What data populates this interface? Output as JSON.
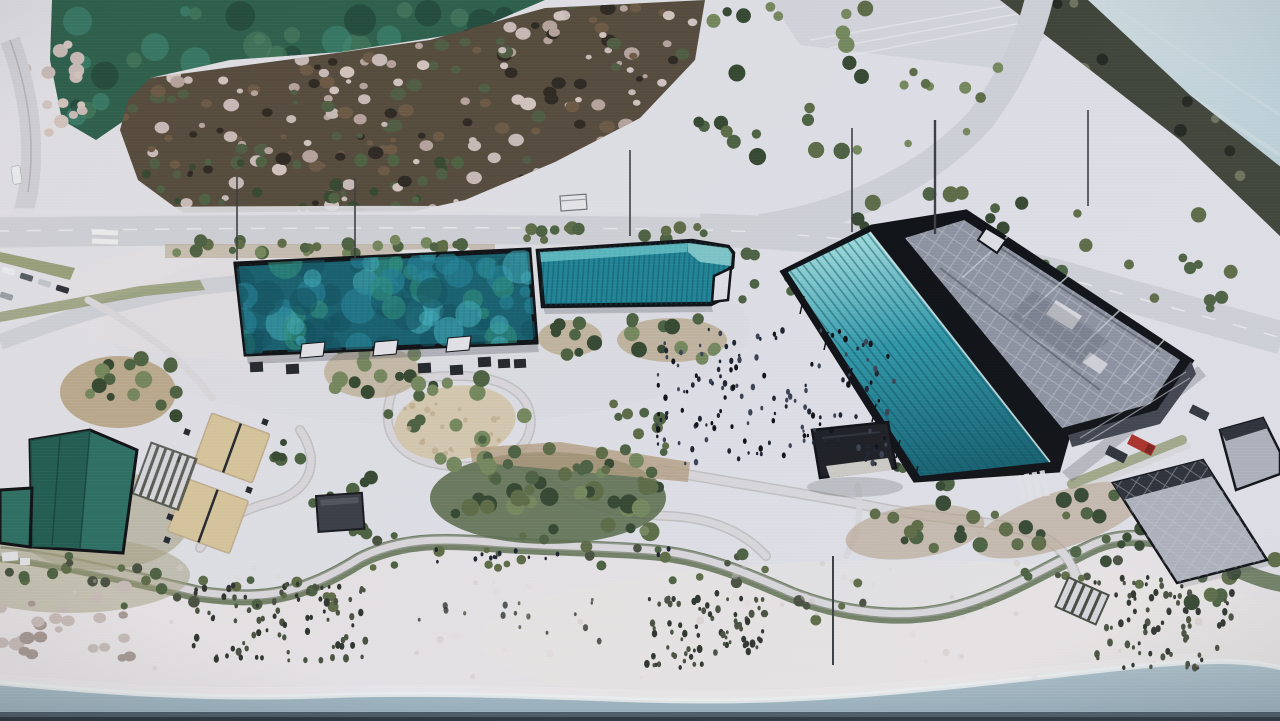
{
  "scene": {
    "kind": "photo-of-architectural-site-plan-rendering",
    "palette": {
      "base": "#e3e3e9",
      "sea": "#b7ced6",
      "sea_light": "#d6e1e4",
      "pond": "#2b5f4c",
      "pond_light": "#498063",
      "pond_dark": "#1b3b32",
      "pond_teal": "#3e8a78",
      "marsh": "#544a3c",
      "blossom": "#d5c6c1",
      "blossom2": "#b7a49d",
      "veg_dark": "#2d2721",
      "veg_brown": "#6b5844",
      "veg_green": "#4e5c42",
      "band": "#3f4337",
      "band_light": "#6e725c",
      "band_dark": "#23261f",
      "road": "#d2d3d9",
      "road_edge": "#a7a8ae",
      "dash": "#f0f1f3",
      "verge": "#86905f",
      "verge_soil": "#b3a489",
      "island": "#bcab8d",
      "lawn": "#a49f7d",
      "court": "#d9c79c",
      "court_line": "#24272e",
      "oval": "#d8cab0",
      "oval_dot": "#c2ae8e",
      "bed": "#b59d80",
      "mound": "#5d6e4e",
      "tree_dark": "#35472f",
      "tree_green": "#4c6140",
      "tree_light": "#75875c",
      "tree_olive": "#5d6b45",
      "roof1_base": "#17606f",
      "roof1_a": "#3fa9b5",
      "roof1_b": "#23849a",
      "roof1_c": "#11505f",
      "roof1_d": "#2f8f7c",
      "b2_top": "#6ecbcf",
      "b2_mid": "#1f8496",
      "b2_tip": "#8fd4d4",
      "b2_stripe": "#0c4f5f",
      "canopy_light": "#9fdede",
      "canopy_mid": "#2e97a8",
      "canopy_deep": "#14606f",
      "canopy_stripe": "#0d4f5e",
      "roof3": "#8e93a0",
      "roof3_light": "#c9ccd5",
      "roof3_dark": "#50545e",
      "facade": "#3f434d",
      "black": "#0d0f12",
      "left_roof": "#2c6e62",
      "left_roof_dark": "#1f584e",
      "gazebo": "#1b1d22",
      "floor": "#cfccc6",
      "shelter": "#3a3d44",
      "rgray": "#aeb2bc",
      "rgray_dark": "#2b2e36",
      "sand": "#eae6e8",
      "sand_warm": "#e2d8d6",
      "water": "#afc3cc",
      "water_deep": "#97aeba",
      "foam": "#f1f3f2",
      "shore_strip": "#46525c",
      "shore_deep": "#2b353d",
      "grass_dark": "#2e332c",
      "grass_mid": "#49503f",
      "crowd_a": "#1d222e",
      "crowd_b": "#394050",
      "rock_a": "#cabdb9",
      "rock_b": "#a89a94",
      "path_c": "#dcdadd",
      "path_edge": "#a5a49f",
      "red_truck": "#ab2f26",
      "van": "#2c3038",
      "white_v": "#eceff1",
      "car_a": "#c4c8cd",
      "car_b": "#565c64",
      "car_c": "#9aa0a6",
      "pole": "#3a3d40",
      "hut": "#e9e9ed",
      "steps": "#d9d9de",
      "steps_bg": "#44483f",
      "wash_cool": "#d7d7e0",
      "wash_warm": "#efe7e3",
      "shadow": "#5b5e66",
      "stall": "#23262b",
      "notch": "#e6e6ea"
    },
    "scatter": [
      {
        "id": "pondTex",
        "x": 70,
        "y": 2,
        "w": 440,
        "h": 120,
        "n": 48,
        "rmin": 5,
        "rmax": 16,
        "colors": [
          "pond_light",
          "pond_dark",
          "pond_teal"
        ],
        "op": 0.55,
        "sq": 1,
        "seed": 11
      },
      {
        "id": "marshTex",
        "x": 85,
        "y": 0,
        "w": 610,
        "h": 225,
        "n": 300,
        "rmin": 2.5,
        "rmax": 8,
        "colors": [
          "blossom",
          "blossom2",
          "veg_dark",
          "veg_brown",
          "veg_green",
          "rock_a"
        ],
        "op": 1,
        "sq": 0.8,
        "seed": 12
      },
      {
        "id": "marshEdge",
        "x": 100,
        "y": 158,
        "w": 370,
        "h": 62,
        "n": 42,
        "rmin": 3,
        "rmax": 7,
        "colors": [
          "veg_green",
          "tree_dark",
          "tree_green"
        ],
        "op": 1,
        "sq": 1,
        "seed": 58
      },
      {
        "id": "bandTex",
        "x": 990,
        "y": 0,
        "w": 290,
        "h": 240,
        "n": 60,
        "rmin": 3,
        "rmax": 8,
        "colors": [
          "band_light",
          "band_dark"
        ],
        "op": 1,
        "sq": 1,
        "seed": 13
      },
      {
        "id": "roof1Tex",
        "x": 238,
        "y": 252,
        "w": 296,
        "h": 98,
        "n": 85,
        "rmin": 5,
        "rmax": 18,
        "colors": [
          "roof1_a",
          "roof1_b",
          "roof1_c",
          "roof1_d"
        ],
        "op": 0.6,
        "sq": 1,
        "seed": 14
      },
      {
        "id": "rowSouth",
        "x": 168,
        "y": 240,
        "w": 325,
        "h": 14,
        "n": 26,
        "rmin": 3.5,
        "rmax": 7,
        "colors": [
          "tree_olive",
          "tree_green",
          "tree_light"
        ],
        "op": 1,
        "sq": 1,
        "seed": 15
      },
      {
        "id": "rowEast",
        "x": 498,
        "y": 226,
        "w": 208,
        "h": 14,
        "n": 14,
        "rmin": 3.5,
        "rmax": 7,
        "colors": [
          "tree_olive",
          "tree_green"
        ],
        "op": 1,
        "sq": 1,
        "seed": 16
      },
      {
        "id": "neTreesA",
        "x": 848,
        "y": 186,
        "w": 200,
        "h": 44,
        "n": 10,
        "rmin": 4,
        "rmax": 8,
        "colors": [
          "tree_green",
          "tree_olive",
          "tree_dark"
        ],
        "op": 1,
        "sq": 1,
        "seed": 17
      },
      {
        "id": "neTreesB",
        "x": 1035,
        "y": 212,
        "w": 170,
        "h": 60,
        "n": 9,
        "rmin": 4,
        "rmax": 8,
        "colors": [
          "tree_green",
          "tree_olive"
        ],
        "op": 1,
        "sq": 1,
        "seed": 18
      },
      {
        "id": "neTreesC",
        "x": 1130,
        "y": 270,
        "w": 120,
        "h": 50,
        "n": 5,
        "rmin": 4,
        "rmax": 7,
        "colors": [
          "tree_olive",
          "tree_green"
        ],
        "op": 1,
        "sq": 1,
        "seed": 19
      },
      {
        "id": "topMidA",
        "x": 695,
        "y": 5,
        "w": 175,
        "h": 160,
        "n": 24,
        "rmin": 4,
        "rmax": 9,
        "colors": [
          "tree_green",
          "tree_dark",
          "tree_light",
          "tree_olive"
        ],
        "op": 1,
        "sq": 1,
        "seed": 20
      },
      {
        "id": "topMidB",
        "x": 862,
        "y": 30,
        "w": 150,
        "h": 115,
        "n": 9,
        "rmin": 3.5,
        "rmax": 7,
        "colors": [
          "tree_olive",
          "tree_light"
        ],
        "op": 1,
        "sq": 1,
        "seed": 21
      },
      {
        "id": "c1Trees",
        "x": 78,
        "y": 358,
        "w": 100,
        "h": 62,
        "n": 15,
        "rmin": 4,
        "rmax": 9,
        "colors": [
          "tree_dark",
          "tree_green",
          "tree_light"
        ],
        "op": 1,
        "sq": 1,
        "seed": 22
      },
      {
        "id": "c2Trees",
        "x": 330,
        "y": 345,
        "w": 85,
        "h": 50,
        "n": 12,
        "rmin": 4,
        "rmax": 8,
        "colors": [
          "tree_dark",
          "tree_green",
          "tree_light"
        ],
        "op": 1,
        "sq": 1,
        "seed": 23
      },
      {
        "id": "ovalRing",
        "x": 385,
        "y": 372,
        "w": 145,
        "h": 92,
        "n": 17,
        "rmin": 4,
        "rmax": 9,
        "colors": [
          "tree_dark",
          "tree_green",
          "tree_light"
        ],
        "op": 1,
        "sq": 1,
        "seed": 24
      },
      {
        "id": "moundTrees",
        "x": 438,
        "y": 460,
        "w": 225,
        "h": 72,
        "n": 36,
        "rmin": 4.5,
        "rmax": 10,
        "colors": [
          "tree_dark",
          "tree_green",
          "tree_light",
          "tree_olive"
        ],
        "op": 1,
        "sq": 1,
        "seed": 25
      },
      {
        "id": "bedTrees",
        "x": 470,
        "y": 441,
        "w": 220,
        "h": 40,
        "n": 15,
        "rmin": 3.5,
        "rmax": 7,
        "colors": [
          "tree_green",
          "tree_olive"
        ],
        "op": 1,
        "sq": 1,
        "seed": 26
      },
      {
        "id": "mAtrees",
        "x": 542,
        "y": 313,
        "w": 60,
        "h": 42,
        "n": 8,
        "rmin": 4,
        "rmax": 8,
        "colors": [
          "tree_dark",
          "tree_green"
        ],
        "op": 1,
        "sq": 1,
        "seed": 27
      },
      {
        "id": "mBtrees",
        "x": 625,
        "y": 316,
        "w": 100,
        "h": 44,
        "n": 12,
        "rmin": 4,
        "rmax": 8,
        "colors": [
          "tree_dark",
          "tree_green",
          "tree_light"
        ],
        "op": 1,
        "sq": 1,
        "seed": 28
      },
      {
        "id": "c7Trees",
        "x": 605,
        "y": 393,
        "w": 58,
        "h": 46,
        "n": 7,
        "rmin": 4,
        "rmax": 7,
        "colors": [
          "tree_green",
          "tree_olive"
        ],
        "op": 1,
        "sq": 1,
        "seed": 29
      },
      {
        "id": "c9Trees",
        "x": 925,
        "y": 262,
        "w": 110,
        "h": 62,
        "n": 13,
        "rmin": 4,
        "rmax": 9,
        "colors": [
          "tree_dark",
          "tree_green",
          "tree_light"
        ],
        "op": 1,
        "sq": 1,
        "seed": 30
      },
      {
        "id": "gapTrees",
        "x": 735,
        "y": 253,
        "w": 60,
        "h": 48,
        "n": 6,
        "rmin": 4,
        "rmax": 7,
        "colors": [
          "tree_green",
          "tree_olive"
        ],
        "op": 1,
        "sq": 1,
        "seed": 31
      },
      {
        "id": "pavTrees",
        "x": 293,
        "y": 476,
        "w": 84,
        "h": 62,
        "n": 9,
        "rmin": 4,
        "rmax": 8,
        "colors": [
          "tree_dark",
          "tree_green"
        ],
        "op": 1,
        "sq": 1,
        "seed": 32
      },
      {
        "id": "lawnTrees",
        "x": 40,
        "y": 423,
        "w": 82,
        "h": 46,
        "n": 5,
        "rmin": 4,
        "rmax": 7,
        "colors": [
          "tree_olive",
          "tree_green"
        ],
        "op": 1,
        "sq": 1,
        "seed": 33
      },
      {
        "id": "courtSideTrees",
        "x": 262,
        "y": 428,
        "w": 40,
        "h": 88,
        "n": 6,
        "rmin": 3.5,
        "rmax": 7,
        "colors": [
          "tree_green",
          "tree_dark"
        ],
        "op": 1,
        "sq": 1,
        "seed": 34
      },
      {
        "id": "gazTrees",
        "x": 888,
        "y": 438,
        "w": 60,
        "h": 52,
        "n": 6,
        "rmin": 4,
        "rmax": 8,
        "colors": [
          "tree_dark",
          "tree_green"
        ],
        "op": 1,
        "sq": 1,
        "seed": 35
      },
      {
        "id": "rainA",
        "x": 855,
        "y": 503,
        "w": 125,
        "h": 58,
        "n": 11,
        "rmin": 4,
        "rmax": 8,
        "colors": [
          "tree_green",
          "tree_dark",
          "tree_olive"
        ],
        "op": 1,
        "sq": 1,
        "seed": 36
      },
      {
        "id": "rainB",
        "x": 978,
        "y": 488,
        "w": 170,
        "h": 62,
        "n": 13,
        "rmin": 4,
        "rmax": 8,
        "colors": [
          "tree_green",
          "tree_dark",
          "tree_olive"
        ],
        "op": 1,
        "sq": 1,
        "seed": 37
      },
      {
        "id": "c11Trees",
        "x": 1096,
        "y": 526,
        "w": 48,
        "h": 42,
        "n": 6,
        "rmin": 3.5,
        "rmax": 7,
        "colors": [
          "tree_green",
          "tree_dark"
        ],
        "op": 1,
        "sq": 1,
        "seed": 38
      },
      {
        "id": "c12Trees",
        "x": 1188,
        "y": 558,
        "w": 92,
        "h": 46,
        "n": 10,
        "rmin": 4,
        "rmax": 8,
        "colors": [
          "tree_green",
          "tree_olive",
          "tree_dark"
        ],
        "op": 1,
        "sq": 1,
        "seed": 39
      },
      {
        "id": "bandShrubs1",
        "x": 0,
        "y": 552,
        "w": 120,
        "h": 34,
        "n": 9,
        "rmin": 3,
        "rmax": 6,
        "colors": [
          "tree_olive",
          "grass_mid",
          "tree_green"
        ],
        "op": 1,
        "sq": 1,
        "seed": 40
      },
      {
        "id": "bandShrubs2",
        "x": 115,
        "y": 566,
        "w": 135,
        "h": 40,
        "n": 10,
        "rmin": 3,
        "rmax": 6,
        "colors": [
          "tree_olive",
          "grass_mid",
          "tree_green"
        ],
        "op": 1,
        "sq": 1,
        "seed": 41
      },
      {
        "id": "bandShrubs3",
        "x": 245,
        "y": 572,
        "w": 115,
        "h": 36,
        "n": 8,
        "rmin": 3,
        "rmax": 6,
        "colors": [
          "tree_olive",
          "grass_mid",
          "tree_green"
        ],
        "op": 1,
        "sq": 1,
        "seed": 42
      },
      {
        "id": "bandShrubs4",
        "x": 352,
        "y": 532,
        "w": 150,
        "h": 36,
        "n": 10,
        "rmin": 3,
        "rmax": 6,
        "colors": [
          "tree_olive",
          "grass_mid",
          "tree_green"
        ],
        "op": 1,
        "sq": 1,
        "seed": 43
      },
      {
        "id": "bandShrubs5",
        "x": 495,
        "y": 536,
        "w": 155,
        "h": 36,
        "n": 10,
        "rmin": 3,
        "rmax": 6,
        "colors": [
          "tree_olive",
          "grass_mid",
          "tree_green"
        ],
        "op": 1,
        "sq": 1,
        "seed": 44
      },
      {
        "id": "bandShrubs6",
        "x": 642,
        "y": 546,
        "w": 130,
        "h": 44,
        "n": 9,
        "rmin": 3,
        "rmax": 6,
        "colors": [
          "tree_olive",
          "grass_mid",
          "tree_green"
        ],
        "op": 1,
        "sq": 1,
        "seed": 45
      },
      {
        "id": "bandShrubs7",
        "x": 762,
        "y": 582,
        "w": 125,
        "h": 40,
        "n": 8,
        "rmin": 3,
        "rmax": 6,
        "colors": [
          "tree_olive",
          "grass_mid",
          "tree_green"
        ],
        "op": 1,
        "sq": 1,
        "seed": 46
      },
      {
        "id": "bandShrubs8",
        "x": 995,
        "y": 538,
        "w": 150,
        "h": 48,
        "n": 10,
        "rmin": 3,
        "rmax": 6,
        "colors": [
          "tree_olive",
          "grass_mid",
          "tree_green"
        ],
        "op": 1,
        "sq": 1,
        "seed": 47
      },
      {
        "id": "crowd",
        "x": 652,
        "y": 328,
        "w": 242,
        "h": 136,
        "n": 150,
        "rmin": 1.1,
        "rmax": 2.3,
        "colors": [
          "crowd_a",
          "crowd_b",
          "black"
        ],
        "op": 1,
        "sq": 1.5,
        "seed": 48
      },
      {
        "id": "pplPath",
        "x": 430,
        "y": 548,
        "w": 240,
        "h": 16,
        "n": 14,
        "rmin": 1.2,
        "rmax": 2,
        "colors": [
          "crowd_a"
        ],
        "op": 1,
        "sq": 1.4,
        "seed": 57
      },
      {
        "id": "grassB1",
        "x": 192,
        "y": 584,
        "w": 178,
        "h": 78,
        "n": 88,
        "rmin": 1.4,
        "rmax": 3,
        "colors": [
          "grass_dark",
          "grass_mid"
        ],
        "op": 1,
        "sq": 1.4,
        "seed": 49
      },
      {
        "id": "grassB2",
        "x": 645,
        "y": 593,
        "w": 118,
        "h": 76,
        "n": 75,
        "rmin": 1.4,
        "rmax": 3,
        "colors": [
          "grass_dark",
          "grass_mid"
        ],
        "op": 1,
        "sq": 1.4,
        "seed": 50
      },
      {
        "id": "grassB3",
        "x": 1085,
        "y": 576,
        "w": 150,
        "h": 92,
        "n": 80,
        "rmin": 1.4,
        "rmax": 3,
        "colors": [
          "grass_dark",
          "grass_mid"
        ],
        "op": 1,
        "sq": 1.4,
        "seed": 51
      },
      {
        "id": "grassMid",
        "x": 392,
        "y": 598,
        "w": 215,
        "h": 48,
        "n": 16,
        "rmin": 1.2,
        "rmax": 2.6,
        "colors": [
          "grass_dark",
          "grass_mid"
        ],
        "op": 0.8,
        "sq": 1.4,
        "seed": 52
      },
      {
        "id": "rocksShore",
        "x": 0,
        "y": 586,
        "w": 135,
        "h": 72,
        "n": 26,
        "rmin": 3.5,
        "rmax": 8,
        "colors": [
          "rock_a",
          "rock_b"
        ],
        "op": 1,
        "sq": 0.8,
        "seed": 53
      },
      {
        "id": "rocksPond",
        "x": 24,
        "y": 42,
        "w": 66,
        "h": 95,
        "n": 16,
        "rmin": 3.5,
        "rmax": 8,
        "colors": [
          "rock_a",
          "blossom"
        ],
        "op": 1,
        "sq": 0.9,
        "seed": 54
      },
      {
        "id": "ovalDots",
        "x": 398,
        "y": 392,
        "w": 112,
        "h": 62,
        "n": 22,
        "rmin": 1.5,
        "rmax": 3.5,
        "colors": [
          "oval_dot"
        ],
        "op": 0.8,
        "sq": 1,
        "seed": 55
      },
      {
        "id": "sandGrain",
        "x": 60,
        "y": 560,
        "w": 1160,
        "h": 120,
        "n": 55,
        "rmin": 1.5,
        "rmax": 4,
        "colors": [
          "sand_warm",
          "rock_a"
        ],
        "op": 0.35,
        "sq": 1,
        "seed": 56
      }
    ]
  }
}
